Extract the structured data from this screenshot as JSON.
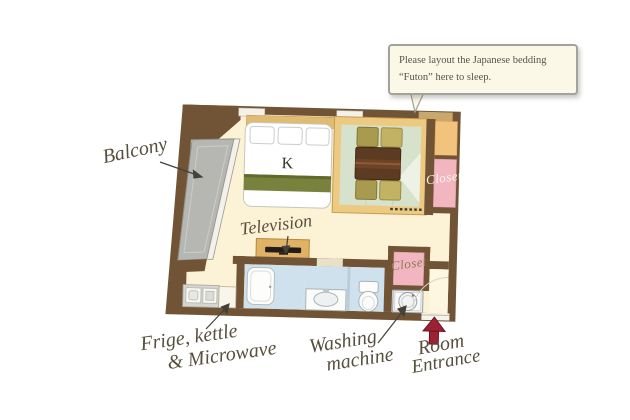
{
  "callout": {
    "line1": "Please layout the Japanese bedding",
    "line2": "“Futon” here to sleep."
  },
  "bed": {
    "size_label": "K"
  },
  "labels": {
    "balcony": "Balcony",
    "television": "Television",
    "fridge_line1": "Frige, kettle",
    "fridge_line2": "& Microwave",
    "washing_line1": "Washing",
    "washing_line2": "machine",
    "entrance_line1": "Room",
    "entrance_line2": "Entrance",
    "closet_upper": "Closet",
    "closet_lower": "Closet"
  },
  "colors": {
    "wall": "#715436",
    "floor": "#fcf2d5",
    "balcony": "#b6b6b2",
    "tatami": "#d7e2cc",
    "tatami_frame": "#ecca82",
    "closet_pink": "#f2b6c1",
    "bathroom_blue": "#cfe1ec",
    "bed_stripe": "#78823c",
    "table": "#5b3b22",
    "cushion_olive": "#a89a4e",
    "cushion_tan": "#c2b264",
    "tv_stand": "#dfb266",
    "entrance_arrow_red": "#9e2133",
    "label_text": "#57503f",
    "callout_bg": "#fbf8e8",
    "callout_border": "#a3a39b"
  }
}
